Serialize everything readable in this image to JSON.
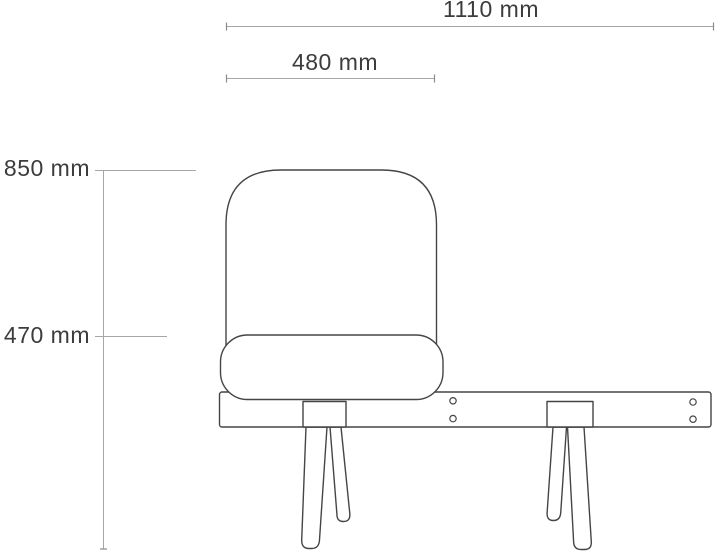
{
  "drawing": {
    "subject": "chair-bench-elevation",
    "labels": {
      "total_width": "1110 mm",
      "seat_width": "480 mm",
      "back_height": "850 mm",
      "seat_height": "470 mm"
    },
    "colors": {
      "outline": "#454545",
      "dimension_line": "#a6a6a6",
      "dimension_tick": "#8a8a8a",
      "label_text": "#3c3c3c",
      "background": "#ffffff"
    }
  }
}
